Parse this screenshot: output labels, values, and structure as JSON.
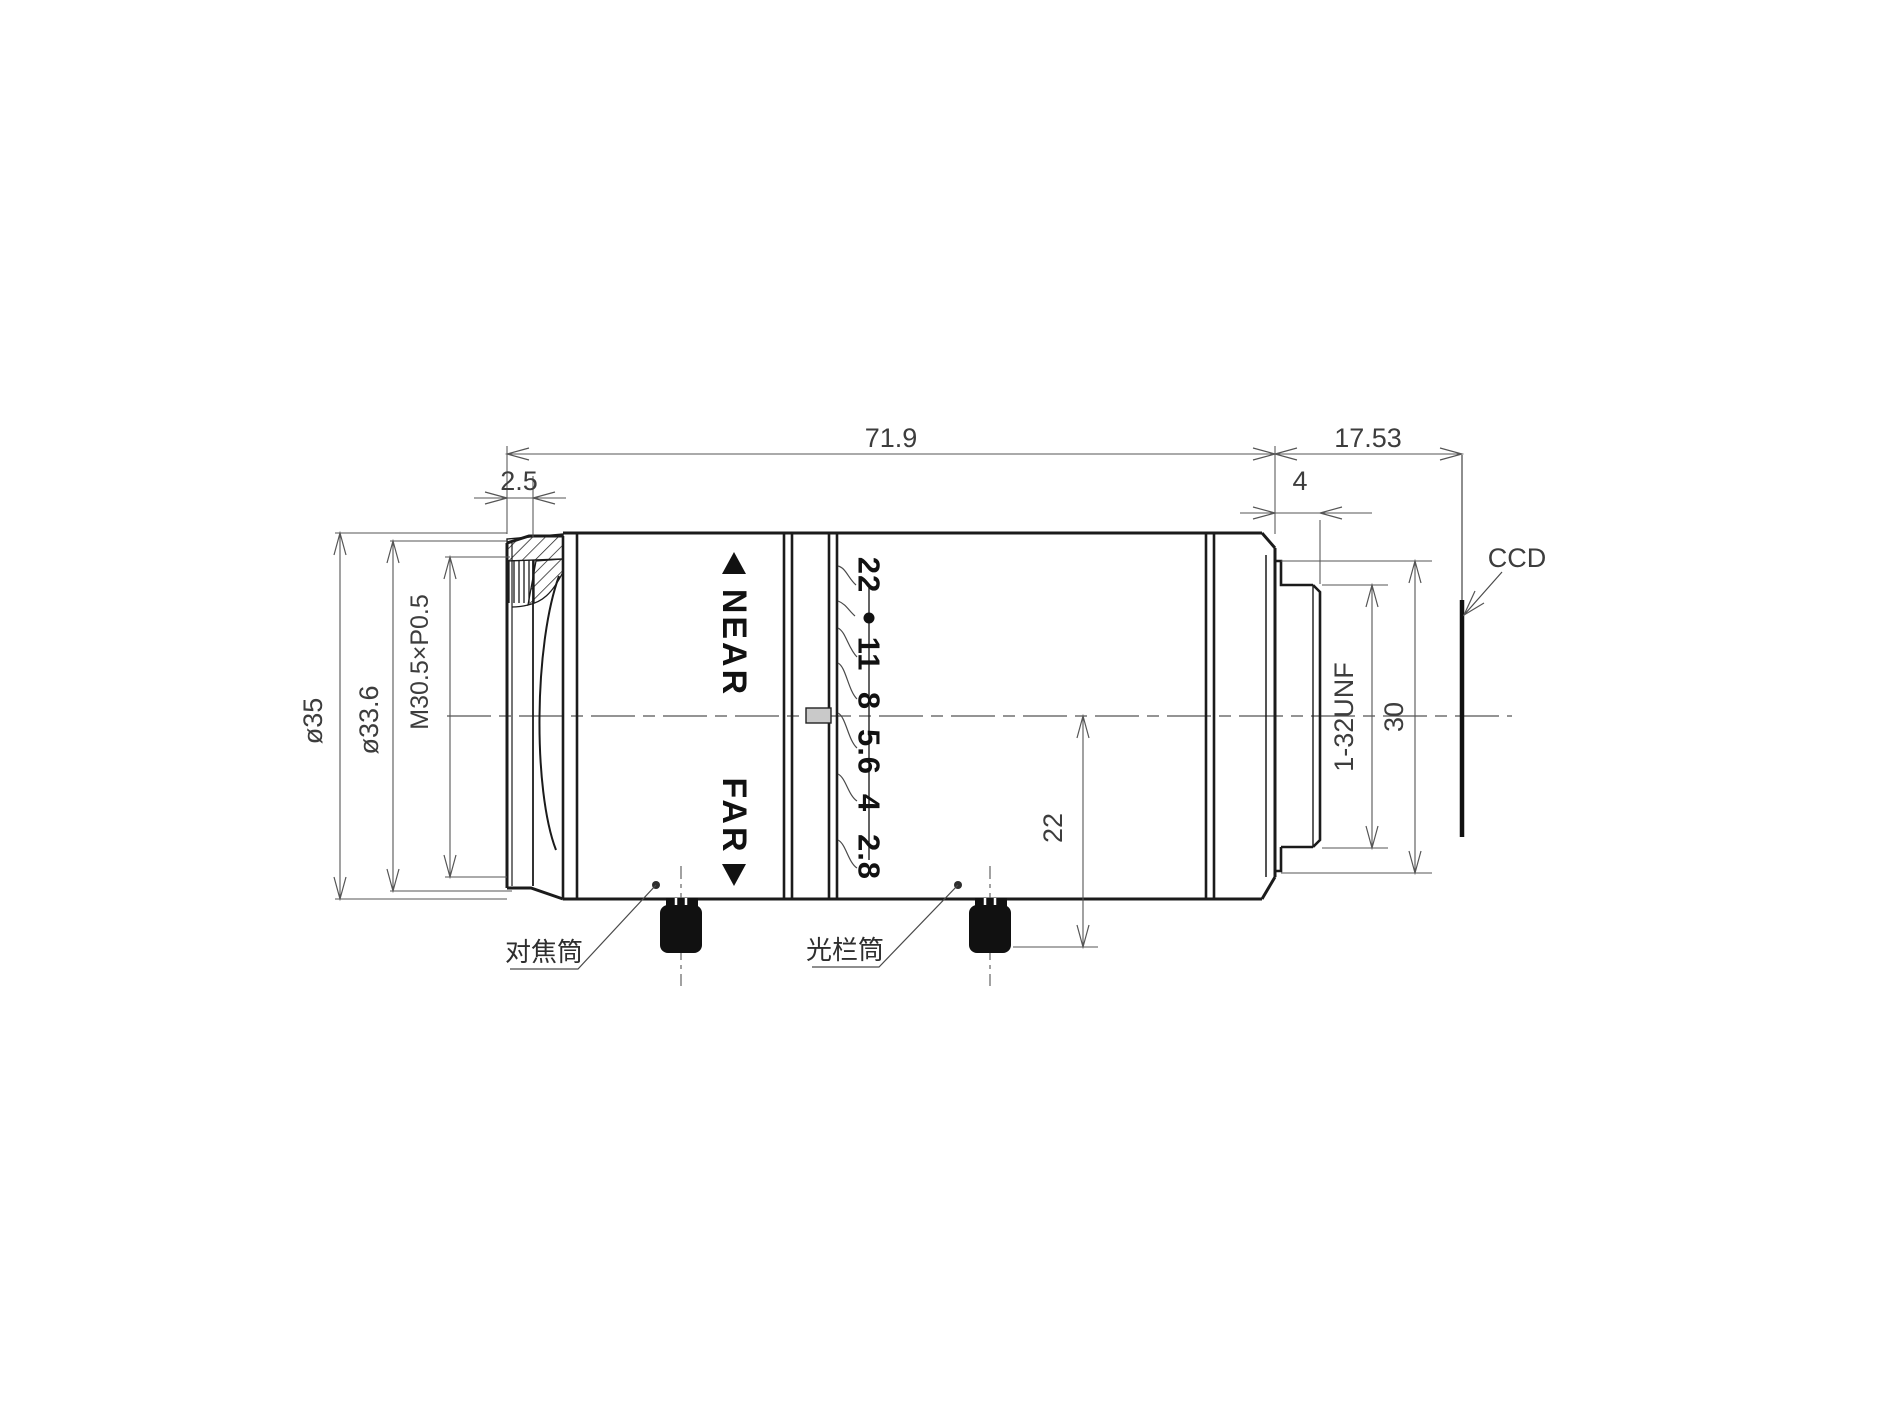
{
  "drawing": {
    "title_hint": "lens mechanical drawing",
    "dims": {
      "overall_length": "71.9",
      "front_lip": "2.5",
      "back_focal": "17.53",
      "thread_length": "4",
      "outer_dia": "ø35",
      "front_inner_dia": "ø33.6",
      "filter_thread": "M30.5×P0.5",
      "mount_step_dia": "30",
      "mount_thread": "1-32UNF",
      "knob_offset": "22"
    },
    "focus": {
      "near": "NEAR",
      "far": "FAR"
    },
    "aperture": {
      "values": [
        "22",
        "11",
        "8",
        "5.6",
        "4",
        "2.8"
      ]
    },
    "labels": {
      "sensor": "CCD",
      "focus_barrel": "对焦筒",
      "aperture_barrel": "光栏筒"
    }
  }
}
